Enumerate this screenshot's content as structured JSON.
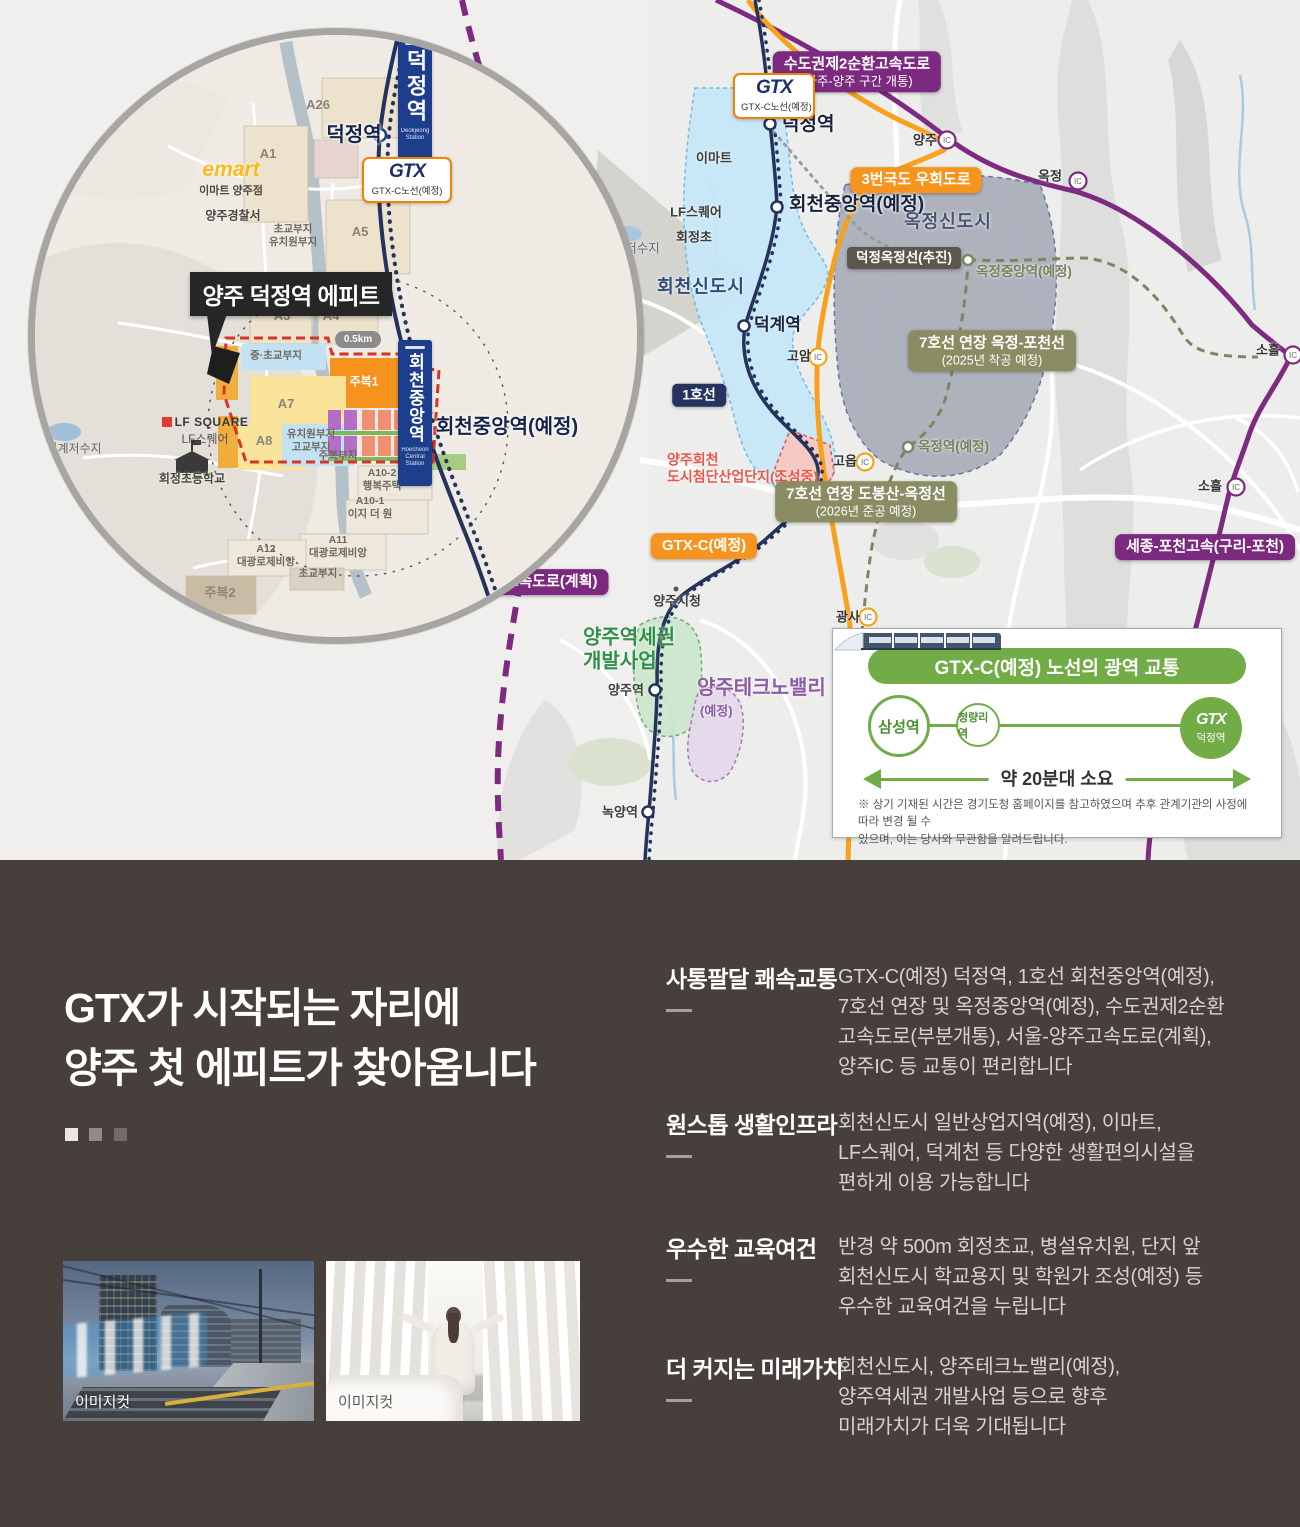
{
  "colors": {
    "map_bg": "#EDEDEB",
    "highway_purple": "#7B2A80",
    "road_orange": "#F6A21D",
    "rail_navy": "#24335C",
    "gtx_dot_orange": "#EE7E23",
    "line7_olive": "#7E8560",
    "newtown_blue": "#C7E7F8",
    "newtown_gray": "#A9ADBA",
    "accent_green": "#72AC47",
    "site_red": "#D63428",
    "bottom_bg": "#463F3B"
  },
  "map": {
    "gtx_badge": {
      "logo": "GTX",
      "line": "GTX-C노선(예정)"
    },
    "labels": [
      {
        "cls": "bdg bdg-purple",
        "x": 857,
        "y": 72,
        "t": "수도권제2순환고속도로",
        "sub": "(파주-양주 구간 개통)"
      },
      {
        "cls": "icn",
        "x": 925,
        "y": 140,
        "t": "양주"
      },
      {
        "cls": "bdg bdg-orange",
        "x": 916,
        "y": 180,
        "t": "3번국도 우회도로"
      },
      {
        "cls": "icn",
        "x": 1050,
        "y": 176,
        "t": "옥정"
      },
      {
        "cls": "poi",
        "x": 714,
        "y": 158,
        "t": "이마트"
      },
      {
        "cls": "station-lg left",
        "x": 782,
        "y": 125,
        "t": "덕정역"
      },
      {
        "cls": "station-lg left",
        "x": 789,
        "y": 205,
        "t": "회천중앙역(예정)"
      },
      {
        "cls": "poi",
        "x": 696,
        "y": 212,
        "t": "LF스퀘어"
      },
      {
        "cls": "poi",
        "x": 694,
        "y": 237,
        "t": "회정초"
      },
      {
        "cls": "poi-light",
        "x": 631,
        "y": 249,
        "t": "덕계저수지"
      },
      {
        "cls": "district",
        "x": 701,
        "y": 287,
        "t": "회천신도시"
      },
      {
        "cls": "district slate",
        "x": 948,
        "y": 222,
        "t": "옥정신도시"
      },
      {
        "cls": "bdg bdg-dark",
        "x": 904,
        "y": 258,
        "t": "덕정옥정선(추진)"
      },
      {
        "cls": "olive-label left",
        "x": 976,
        "y": 272,
        "t": "옥정중앙역(예정)"
      },
      {
        "cls": "bdg bdg-olive",
        "x": 992,
        "y": 351,
        "t": "7호선 연장 옥정-포천선",
        "sub": "(2025년 착공 예정)"
      },
      {
        "cls": "station-md left",
        "x": 754,
        "y": 325,
        "t": "덕계역"
      },
      {
        "cls": "icn",
        "x": 799,
        "y": 356,
        "t": "고암"
      },
      {
        "cls": "bdg bdg-navy",
        "x": 699,
        "y": 395,
        "t": "1호선"
      },
      {
        "cls": "red-label left",
        "x": 667,
        "y": 468,
        "t": "양주회천\n도시첨단산업단지(조성중)"
      },
      {
        "cls": "icn",
        "x": 845,
        "y": 461,
        "t": "고읍"
      },
      {
        "cls": "olive-label left",
        "x": 918,
        "y": 447,
        "t": "옥정역(예정)"
      },
      {
        "cls": "bdg bdg-olive",
        "x": 866,
        "y": 502,
        "t": "7호선 연장 도봉산-옥정선",
        "sub": "(2026년 준공 예정)"
      },
      {
        "cls": "bdg bdg-orange",
        "x": 704,
        "y": 546,
        "t": "GTX-C(예정)"
      },
      {
        "cls": "icn",
        "x": 1268,
        "y": 350,
        "t": "소흘"
      },
      {
        "cls": "icn",
        "x": 1210,
        "y": 486,
        "t": "소흘"
      },
      {
        "cls": "bdg bdg-purple",
        "x": 1205,
        "y": 547,
        "t": "세종-포천고속(구리-포천)"
      },
      {
        "cls": "bdg bdg-purple",
        "x": 521,
        "y": 582,
        "t": "서울-양주고속도로(계획)"
      },
      {
        "cls": "poi",
        "x": 677,
        "y": 601,
        "t": "양주시청"
      },
      {
        "cls": "green-label left",
        "x": 583,
        "y": 650,
        "t": "양주역세권\n개발사업"
      },
      {
        "cls": "purple-label left",
        "x": 697,
        "y": 689,
        "t": "양주테크노밸리"
      },
      {
        "cls": "purple-label-sm left",
        "x": 700,
        "y": 711,
        "t": "(예정)"
      },
      {
        "cls": "poi",
        "x": 626,
        "y": 690,
        "t": "양주역"
      },
      {
        "cls": "poi",
        "x": 620,
        "y": 812,
        "t": "녹양역"
      },
      {
        "cls": "icn",
        "x": 848,
        "y": 617,
        "t": "광사"
      }
    ],
    "inset": {
      "site_label": "양주 덕정역 에피트",
      "scale_badge": "0.5km",
      "signs": [
        {
          "text": "덕정역",
          "sub": "Deokjeong\nStation"
        },
        {
          "text": "회천중앙역",
          "sub": "Hoecheon\nCentral Station"
        }
      ],
      "gtx_box": {
        "logo": "GTX",
        "line": "GTX-C노선(예정)"
      },
      "emart": {
        "logo": "emart",
        "name": "이마트 양주점"
      },
      "lf": {
        "logo": "LF SQUARE",
        "name": "LF스퀘어"
      },
      "labels": [
        {
          "cls": "zone",
          "x": 290,
          "y": 77,
          "t": "A26"
        },
        {
          "cls": "zone",
          "x": 240,
          "y": 126,
          "t": "A1"
        },
        {
          "cls": "big-station",
          "x": 326,
          "y": 107,
          "t": "덕정역"
        },
        {
          "cls": "poi2",
          "x": 205,
          "y": 188,
          "t": "양주경찰서"
        },
        {
          "cls": "zone-sm",
          "x": 265,
          "y": 208,
          "t": "초교부지\n유치원부지"
        },
        {
          "cls": "zone",
          "x": 332,
          "y": 204,
          "t": "A5"
        },
        {
          "cls": "zone",
          "x": 254,
          "y": 288,
          "t": "A3"
        },
        {
          "cls": "zone",
          "x": 303,
          "y": 288,
          "t": "A4"
        },
        {
          "cls": "zone-sm",
          "x": 248,
          "y": 328,
          "t": "중·초교부지"
        },
        {
          "cls": "zone-w",
          "x": 336,
          "y": 354,
          "t": "주복1"
        },
        {
          "cls": "zone",
          "x": 258,
          "y": 376,
          "t": "A7"
        },
        {
          "cls": "zone",
          "x": 236,
          "y": 413,
          "t": "A8"
        },
        {
          "cls": "zone-sm",
          "x": 283,
          "y": 413,
          "t": "유치원부지\n고교부지"
        },
        {
          "cls": "zone-sm",
          "x": 310,
          "y": 428,
          "t": "주복부지"
        },
        {
          "cls": "big-station left",
          "x": 408,
          "y": 399,
          "t": "회천중앙역(예정)"
        },
        {
          "cls": "zone-sm",
          "x": 354,
          "y": 452,
          "t": "A10-2\n행복주택"
        },
        {
          "cls": "zone-sm",
          "x": 342,
          "y": 480,
          "t": "A10-1\n이지 더 원"
        },
        {
          "cls": "zone-sm",
          "x": 310,
          "y": 519,
          "t": "A11\n대광로제비앙"
        },
        {
          "cls": "zone-sm",
          "x": 238,
          "y": 528,
          "t": "A12\n대광로제비앙"
        },
        {
          "cls": "zone-sm",
          "x": 290,
          "y": 546,
          "t": "초교부지"
        },
        {
          "cls": "zone",
          "x": 192,
          "y": 565,
          "t": "주복2"
        },
        {
          "cls": "poi2-light",
          "x": 46,
          "y": 421,
          "t": "덕계저수지"
        },
        {
          "cls": "poi2",
          "x": 164,
          "y": 451,
          "t": "회정초등학교"
        }
      ]
    },
    "info_box": {
      "title": "GTX-C(예정) 노선의 광역 교통",
      "stations": [
        {
          "name": "삼성역"
        },
        {
          "name": "청량리역"
        },
        {
          "name": "덕정역",
          "logo": "GTX"
        }
      ],
      "duration": "약 20분대 소요",
      "note": "※ 상기 기재된 시간은 경기도청 홈페이지를 참고하였으며 추후 관계기관의 사정에 따라 변경 될 수\n있으며, 이는 당사와 무관함을 알려드립니다."
    }
  },
  "bottom": {
    "headline": "GTX가 시작되는 자리에\n양주 첫 에피트가 찾아옵니다",
    "photos": [
      {
        "caption": "이미지컷"
      },
      {
        "caption": "이미지컷"
      }
    ],
    "features": [
      {
        "title": "사통팔달 쾌속교통",
        "body": "GTX-C(예정) 덕정역, 1호선 회천중앙역(예정),\n7호선 연장 및 옥정중앙역(예정), 수도권제2순환\n고속도로(부분개통), 서울-양주고속도로(계획),\n양주IC 등 교통이 편리합니다"
      },
      {
        "title": "원스톱 생활인프라",
        "body": "회천신도시 일반상업지역(예정), 이마트,\nLF스퀘어, 덕계천 등 다양한 생활편의시설을\n편하게 이용 가능합니다"
      },
      {
        "title": "우수한 교육여건",
        "body": "반경 약 500m 회정초교, 병설유치원, 단지 앞\n회천신도시 학교용지 및 학원가 조성(예정) 등\n우수한 교육여건을 누립니다"
      },
      {
        "title": "더 커지는 미래가치",
        "body": "회천신도시, 양주테크노밸리(예정),\n양주역세권 개발사업 등으로 향후\n미래가치가 더욱 기대됩니다"
      }
    ]
  }
}
